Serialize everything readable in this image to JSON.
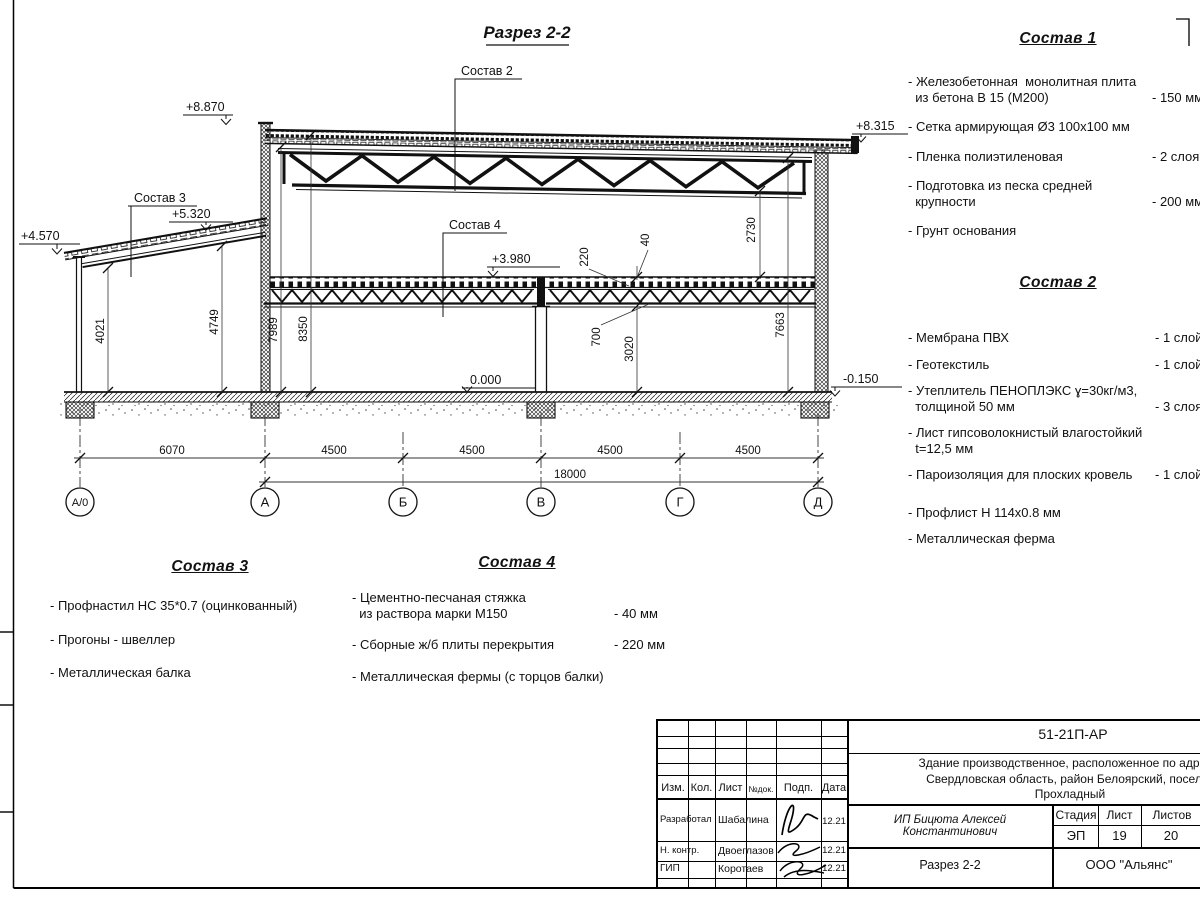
{
  "page": {
    "ink": "#1a1a1a"
  },
  "drawing": {
    "title": "Разрез 2-2",
    "callouts": {
      "c2": "Состав 2",
      "c3": "Состав 3",
      "c4": "Состав 4"
    },
    "elevations": {
      "top_left": "+8.870",
      "top_right": "+8.315",
      "annex_low": "+4.570",
      "annex_high": "+5.320",
      "mezzanine": "+3.980",
      "floor": "0.000",
      "ground": "-0.150"
    },
    "dims_horizontal": {
      "span1": "6070",
      "span2": "4500",
      "span3": "4500",
      "span4": "4500",
      "span5": "4500",
      "total": "18000"
    },
    "dims_vertical": {
      "annex_clear_low": "4021",
      "annex_clear_high": "4749",
      "hall_clear": "7989",
      "hall_full": "8350",
      "slab": "220",
      "screed": "40",
      "truss_depth": "700",
      "under_mezzanine": "3020",
      "above_mezzanine": "2730",
      "right_clear": "7663"
    },
    "axes": [
      "А/0",
      "А",
      "Б",
      "В",
      "Г",
      "Д"
    ]
  },
  "sostav1": {
    "heading": "Состав 1",
    "items": [
      {
        "text": "- Железобетонная  монолитная плита\n  из бетона В 15 (М200)",
        "value": "- 150 мм"
      },
      {
        "text": "- Сетка армирующая Ø3 100х100 мм",
        "value": ""
      },
      {
        "text": "- Пленка полиэтиленовая",
        "value": "-  2 слоя"
      },
      {
        "text": "- Подготовка из песка средней\n  крупности",
        "value": "- 200 мм"
      },
      {
        "text": "- Грунт основания",
        "value": ""
      }
    ]
  },
  "sostav2": {
    "heading": "Состав 2",
    "items": [
      {
        "text": "- Мембрана ПВХ",
        "value": "- 1 слой"
      },
      {
        "text": "- Геотекстиль",
        "value": "- 1 слой"
      },
      {
        "text": "- Утеплитель ПЕНОПЛЭКС ɣ=30кг/м3,\n  толщиной 50 мм",
        "value": "- 3 слоя"
      },
      {
        "text": "- Лист гипсоволокнистый влагостойкий\n  t=12,5 мм",
        "value": ""
      },
      {
        "text": "- Пароизоляция для плоских кровель",
        "value": "- 1 слой"
      },
      {
        "text": "- Профлист Н 114х0.8 мм",
        "value": ""
      },
      {
        "text": "- Металлическая ферма",
        "value": ""
      }
    ]
  },
  "sostav3": {
    "heading": "Состав 3",
    "items": [
      {
        "text": "- Профнастил НС 35*0.7 (оцинкованный)",
        "value": ""
      },
      {
        "text": "- Прогоны - швеллер",
        "value": ""
      },
      {
        "text": "- Металлическая балка",
        "value": ""
      }
    ]
  },
  "sostav4": {
    "heading": "Состав 4",
    "items": [
      {
        "text": "- Цементно-песчаная стяжка\n  из раствора марки М150",
        "value": "- 40 мм"
      },
      {
        "text": "- Сборные ж/б плиты перекрытия",
        "value": "- 220 мм"
      },
      {
        "text": "- Металлическая фермы (с торцов балки)",
        "value": ""
      }
    ]
  },
  "titleblock": {
    "doc_code": "51-21П-АР",
    "project": "Здание производственное, расположенное по адресу:\nСвердловская область, район Белоярский, поселок\nПрохладный",
    "columns": [
      "Изм.",
      "Кол.",
      "Лист",
      "№док.",
      "Подп.",
      "Дата"
    ],
    "rows": [
      {
        "role": "Разработал",
        "name": "Шабалина",
        "date": "12.21"
      },
      {
        "role": "Н. контр.",
        "name": "Двоеглазов",
        "date": "12.21"
      },
      {
        "role": "ГИП",
        "name": "Коротаев",
        "date": "12.21"
      }
    ],
    "client": "ИП Бицюта Алексей Константинович",
    "stage_label": "Стадия",
    "sheet_label": "Лист",
    "sheets_label": "Листов",
    "stage": "ЭП",
    "sheet": "19",
    "sheets": "20",
    "sheet_title": "Разрез 2-2",
    "company": "ООО \"Альянс\""
  }
}
